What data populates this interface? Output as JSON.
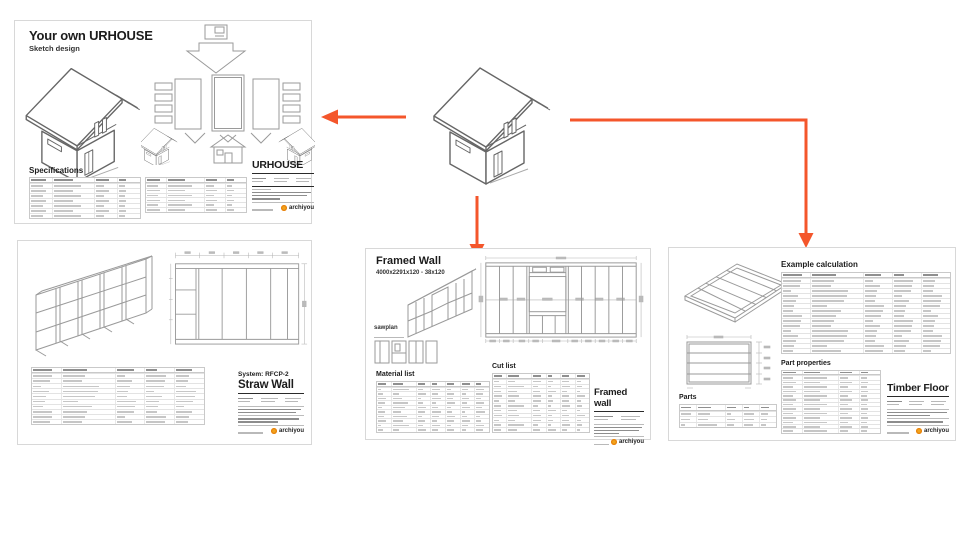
{
  "colors": {
    "accent": "#f4562b",
    "logo-dot": "#f2a51c",
    "sheet-border": "#d8d8d8",
    "line": "#9a9a9a",
    "ink": "#1c1c1c"
  },
  "logo": {
    "text": "archiyou"
  },
  "sheets": {
    "sketch": {
      "title": "Your own URHOUSE",
      "subtitle": "Sketch design",
      "specifications_heading": "Specifications",
      "titleblock_title": "URHOUSE",
      "spec_table_left": {
        "rows": 8,
        "cols": 4
      },
      "spec_table_right": {
        "rows": 7,
        "cols": 4
      }
    },
    "straw": {
      "system_label": "System: RFCP-2",
      "titleblock_title": "Straw Wall",
      "parts_table": {
        "rows": 11,
        "cols": 5
      }
    },
    "framed": {
      "title": "Framed Wall",
      "subtitle": "4000x2291x120 - 38x120",
      "sawplan_label": "sawplan",
      "material_list_heading": "Material list",
      "cut_list_heading": "Cut list",
      "titleblock_title": "Framed wall",
      "material_table": {
        "rows": 11,
        "cols": 7
      },
      "cut_table": {
        "rows": 12,
        "cols": 6
      }
    },
    "timber": {
      "example_heading": "Example calculation",
      "parts_heading": "Parts",
      "part_properties_heading": "Part properties",
      "titleblock_title": "Timber Floor",
      "example_table": {
        "rows": 16,
        "cols": 5
      },
      "parts_table": {
        "rows": 4,
        "cols": 5
      },
      "properties_table": {
        "rows": 14,
        "cols": 4
      }
    }
  }
}
